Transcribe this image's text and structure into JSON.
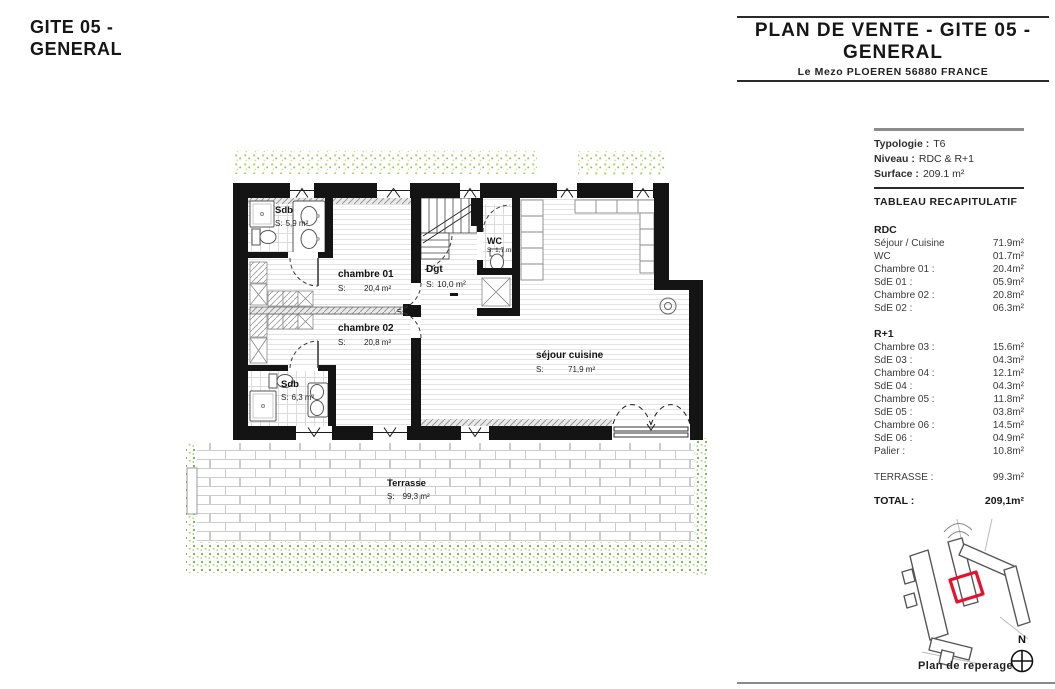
{
  "left_title": {
    "line1": "GITE 05 -",
    "line2": "GENERAL"
  },
  "header": {
    "title_line1": "PLAN DE VENTE - GITE 05 -",
    "title_line2": "GENERAL",
    "subtitle": "Le Mezo PLOEREN 56880 FRANCE"
  },
  "plan": {
    "rooms": {
      "sdb1": {
        "name": "Sdb",
        "prefix": "S:",
        "area": "5,9 m²"
      },
      "chambre01": {
        "name": "chambre 01",
        "prefix": "S:",
        "area": "20,4 m²"
      },
      "chambre02": {
        "name": "chambre 02",
        "prefix": "S:",
        "area": "20,8 m²"
      },
      "sdb2": {
        "name": "Sdb",
        "prefix": "S:",
        "area": "6,3 m²"
      },
      "dgt": {
        "name": "Dgt",
        "prefix": "S:",
        "area": "10,0 m²"
      },
      "wc": {
        "name": "WC",
        "prefix": "S:",
        "area": "1,7 m²"
      },
      "sejour": {
        "name": "séjour cuisine",
        "prefix": "S:",
        "area": "71,9 m²"
      },
      "terrasse": {
        "name": "Terrasse",
        "prefix": "S:",
        "area": "99,3 m²"
      }
    }
  },
  "sidebar": {
    "info": [
      {
        "label": "Typologie :",
        "value": "T6"
      },
      {
        "label": "Niveau :",
        "value": "RDC & R+1"
      },
      {
        "label": "Surface :",
        "value": "209.1 m²"
      }
    ],
    "table_title": "TABLEAU RECAPITULATIF",
    "sections": [
      {
        "title": "RDC",
        "rows": [
          {
            "label": "Séjour / Cuisine",
            "value": "71.9m²"
          },
          {
            "label": "WC",
            "value": "01.7m²"
          },
          {
            "label": "Chambre 01 :",
            "value": "20.4m²"
          },
          {
            "label": "SdE 01 :",
            "value": "05.9m²"
          },
          {
            "label": "Chambre 02 :",
            "value": "20.8m²"
          },
          {
            "label": "SdE 02 :",
            "value": "06.3m²"
          }
        ]
      },
      {
        "title": "R+1",
        "rows": [
          {
            "label": "Chambre 03 :",
            "value": "15.6m²"
          },
          {
            "label": "SdE 03 :",
            "value": "04.3m²"
          },
          {
            "label": "Chambre 04 :",
            "value": "12.1m²"
          },
          {
            "label": "SdE 04 :",
            "value": "04.3m²"
          },
          {
            "label": "Chambre 05 :",
            "value": "11.8m²"
          },
          {
            "label": "SdE 05 :",
            "value": "03.8m²"
          },
          {
            "label": "Chambre 06 :",
            "value": "14.5m²"
          },
          {
            "label": "SdE 06 :",
            "value": "04.9m²"
          },
          {
            "label": "Palier :",
            "value": "10.8m²"
          }
        ]
      }
    ],
    "terrasse": {
      "label": "TERRASSE :",
      "value": "99.3m²"
    },
    "total": {
      "label": "TOTAL :",
      "value": "209,1m²"
    }
  },
  "reperage": {
    "caption": "Plan de reperage",
    "north": "N"
  },
  "colors": {
    "accent_red": "#E8112D",
    "wall": "#141414",
    "vegetation_green": "#6FAE4E"
  }
}
